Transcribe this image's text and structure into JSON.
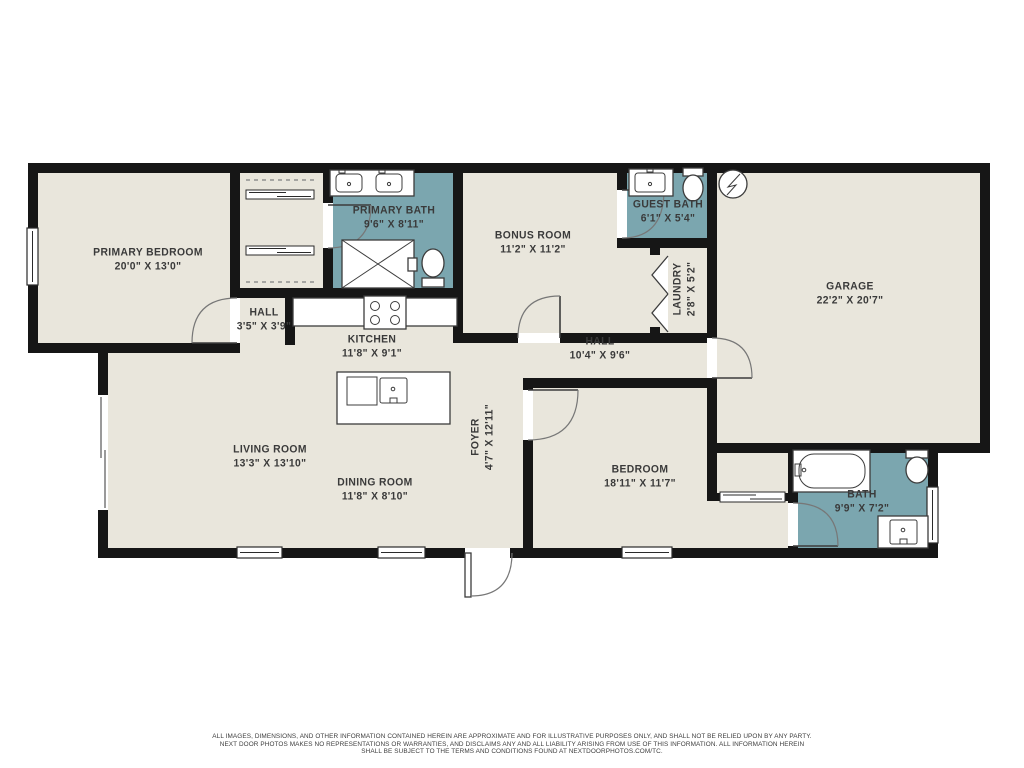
{
  "colors": {
    "wall": "#161616",
    "floor": "#e9e6dc",
    "bath_accent": "#7ba6af",
    "label_text": "#3a3a3a"
  },
  "rooms": [
    {
      "id": "primary-bedroom",
      "name": "PRIMARY BEDROOM",
      "dims": "20'0\" X 13'0\""
    },
    {
      "id": "primary-bath",
      "name": "PRIMARY BATH",
      "dims": "9'6\" X 8'11\""
    },
    {
      "id": "hall-small",
      "name": "HALL",
      "dims": "3'5\" X 3'9\""
    },
    {
      "id": "kitchen",
      "name": "KITCHEN",
      "dims": "11'8\" X 9'1\""
    },
    {
      "id": "bonus-room",
      "name": "BONUS ROOM",
      "dims": "11'2\" X 11'2\""
    },
    {
      "id": "guest-bath",
      "name": "GUEST BATH",
      "dims": "6'1\" X 5'4\""
    },
    {
      "id": "laundry",
      "name": "LAUNDRY",
      "dims": "2'8\" X 5'2\""
    },
    {
      "id": "hall-center",
      "name": "HALL",
      "dims": "10'4\" X 9'6\""
    },
    {
      "id": "garage",
      "name": "GARAGE",
      "dims": "22'2\" X 20'7\""
    },
    {
      "id": "living-room",
      "name": "LIVING ROOM",
      "dims": "13'3\" X 13'10\""
    },
    {
      "id": "dining-room",
      "name": "DINING ROOM",
      "dims": "11'8\" X 8'10\""
    },
    {
      "id": "foyer",
      "name": "FOYER",
      "dims": "4'7\" X 12'11\""
    },
    {
      "id": "bedroom",
      "name": "BEDROOM",
      "dims": "18'11\" X 11'7\""
    },
    {
      "id": "bath",
      "name": "BATH",
      "dims": "9'9\" X 7'2\""
    }
  ],
  "fixtures": [
    "double-vanity-sink",
    "shower",
    "toilet",
    "closet-rod",
    "sliding-closet-door",
    "bifold-laundry-door",
    "water-heater",
    "range-stove",
    "kitchen-island-sink",
    "dishwasher",
    "bathtub",
    "vanity-sink",
    "window",
    "door-swing",
    "sliding-glass-door"
  ],
  "disclaimer": {
    "line1": "ALL IMAGES, DIMENSIONS, AND OTHER INFORMATION CONTAINED HEREIN ARE APPROXIMATE AND FOR ILLUSTRATIVE PURPOSES ONLY, AND SHALL NOT BE RELIED UPON BY ANY PARTY.",
    "line2": "NEXT DOOR PHOTOS MAKES NO REPRESENTATIONS OR WARRANTIES, AND DISCLAIMS ANY AND ALL LIABILITY ARISING FROM USE OF THIS INFORMATION. ALL INFORMATION HEREIN",
    "line3": "SHALL BE SUBJECT TO THE TERMS AND CONDITIONS FOUND AT NEXTDOORPHOTOS.COM/TC."
  }
}
